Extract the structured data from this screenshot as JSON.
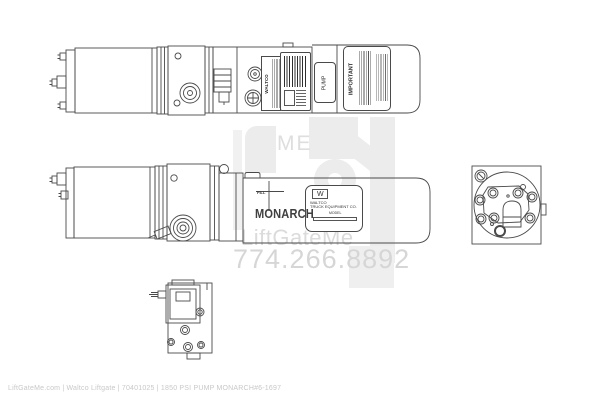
{
  "watermark": {
    "logo_text": "ME",
    "brand": "LiftGateMe",
    "phone": "774.266.8892"
  },
  "footer": {
    "caption": "LiftGateMe.com | Waltco Liftgate | 70401025 | 1850 PSI PUMP MONARCH#6-1697"
  },
  "diagram": {
    "top_view": {
      "side_label_vertical": "WALTCO",
      "pump_label": "PUMP",
      "important_label": "IMPORTANT"
    },
    "side_view": {
      "fill_label": "FILL",
      "brand": "MONARCH",
      "nameplate": {
        "logo_letter": "W",
        "company_line1": "WALTCO",
        "company_line2": "TRUCK EQUIPMENT CO.",
        "model_label": "MODEL"
      }
    }
  },
  "colors": {
    "line": "#4a4a4a",
    "watermark_gray": "#ececec",
    "watermark_text": "#dcdcdc",
    "footer_text": "#c8c8c8",
    "background": "#ffffff"
  }
}
